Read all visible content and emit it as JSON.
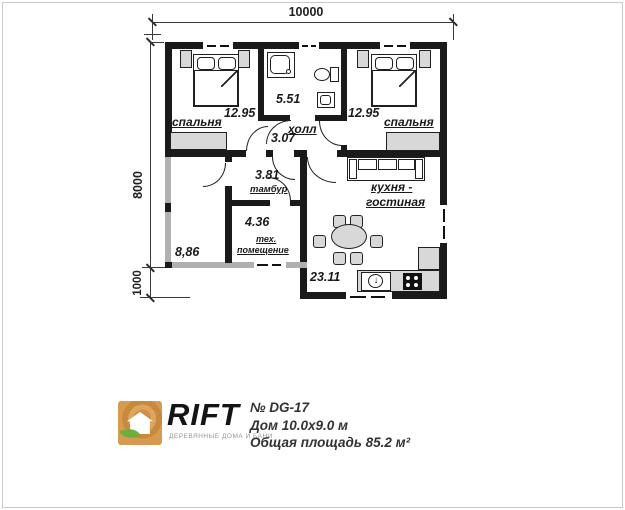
{
  "plan": {
    "dim_top": "10000",
    "dim_left": "8000",
    "dim_left_lower": "1000",
    "rooms": {
      "bedroom_left": {
        "label": "спальня",
        "area": "12.95"
      },
      "bathroom": {
        "area": "5.51"
      },
      "bedroom_right": {
        "label": "спальня",
        "area": "12.95"
      },
      "hall": {
        "label": "холл",
        "area": "3.07"
      },
      "tambour": {
        "label": "тамбур",
        "area": "3.81"
      },
      "tech_room": {
        "label_line1": "тех.",
        "label_line2": "помещение",
        "area": "4.36"
      },
      "terrace": {
        "area": "8,86"
      },
      "kitchen_living": {
        "label_line1": "кухня -",
        "label_line2": "гостиная",
        "area": "23.11"
      }
    }
  },
  "title_block": {
    "brand": "RIFT",
    "tagline": "ДЕРЕВЯННЫЕ ДОМА И БАНИ",
    "project_no": "№ DG-17",
    "house_size": "Дом 10.0x9.0 м",
    "total_area": "Общая площадь 85.2 м²"
  },
  "icons": {
    "sink_arrow": "↓"
  },
  "colors": {
    "wall": "#1a1a1a",
    "cold_wall": "#b0b0b0",
    "furniture_gray": "#d8d8d8",
    "logo_orange": "#cf9144",
    "logo_green": "#6fae3e",
    "text": "#333333"
  }
}
